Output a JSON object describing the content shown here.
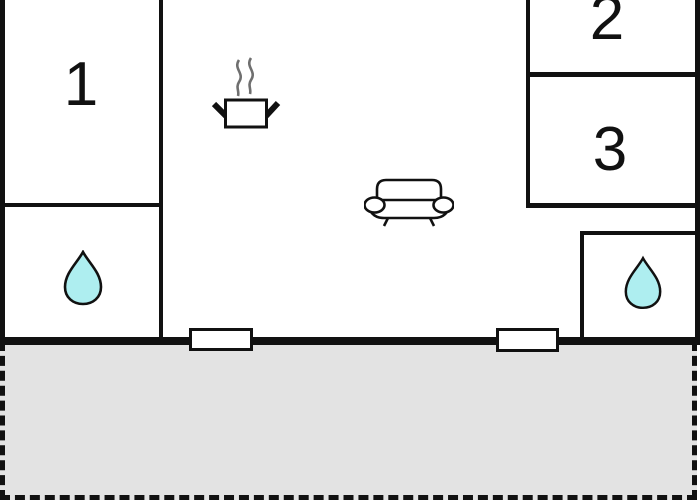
{
  "title": "apartment-floor-plan",
  "rooms": {
    "room1": {
      "label": "1"
    },
    "room2": {
      "label": "2"
    },
    "room3": {
      "label": "3"
    }
  },
  "icons": {
    "cooking_pot": "kitchen cooking pot with steam",
    "sofa": "living room sofa",
    "water_drop_left": "bathroom water drop",
    "water_drop_right": "bathroom water drop"
  },
  "colors": {
    "wall": "#111111",
    "terrace_fill": "#e3e3e3",
    "water_drop_fill": "#aeeef0",
    "water_drop_stroke": "#111111",
    "steam_stroke": "#6f6f6f",
    "icon_stroke": "#111111",
    "icon_fill": "#ffffff"
  }
}
